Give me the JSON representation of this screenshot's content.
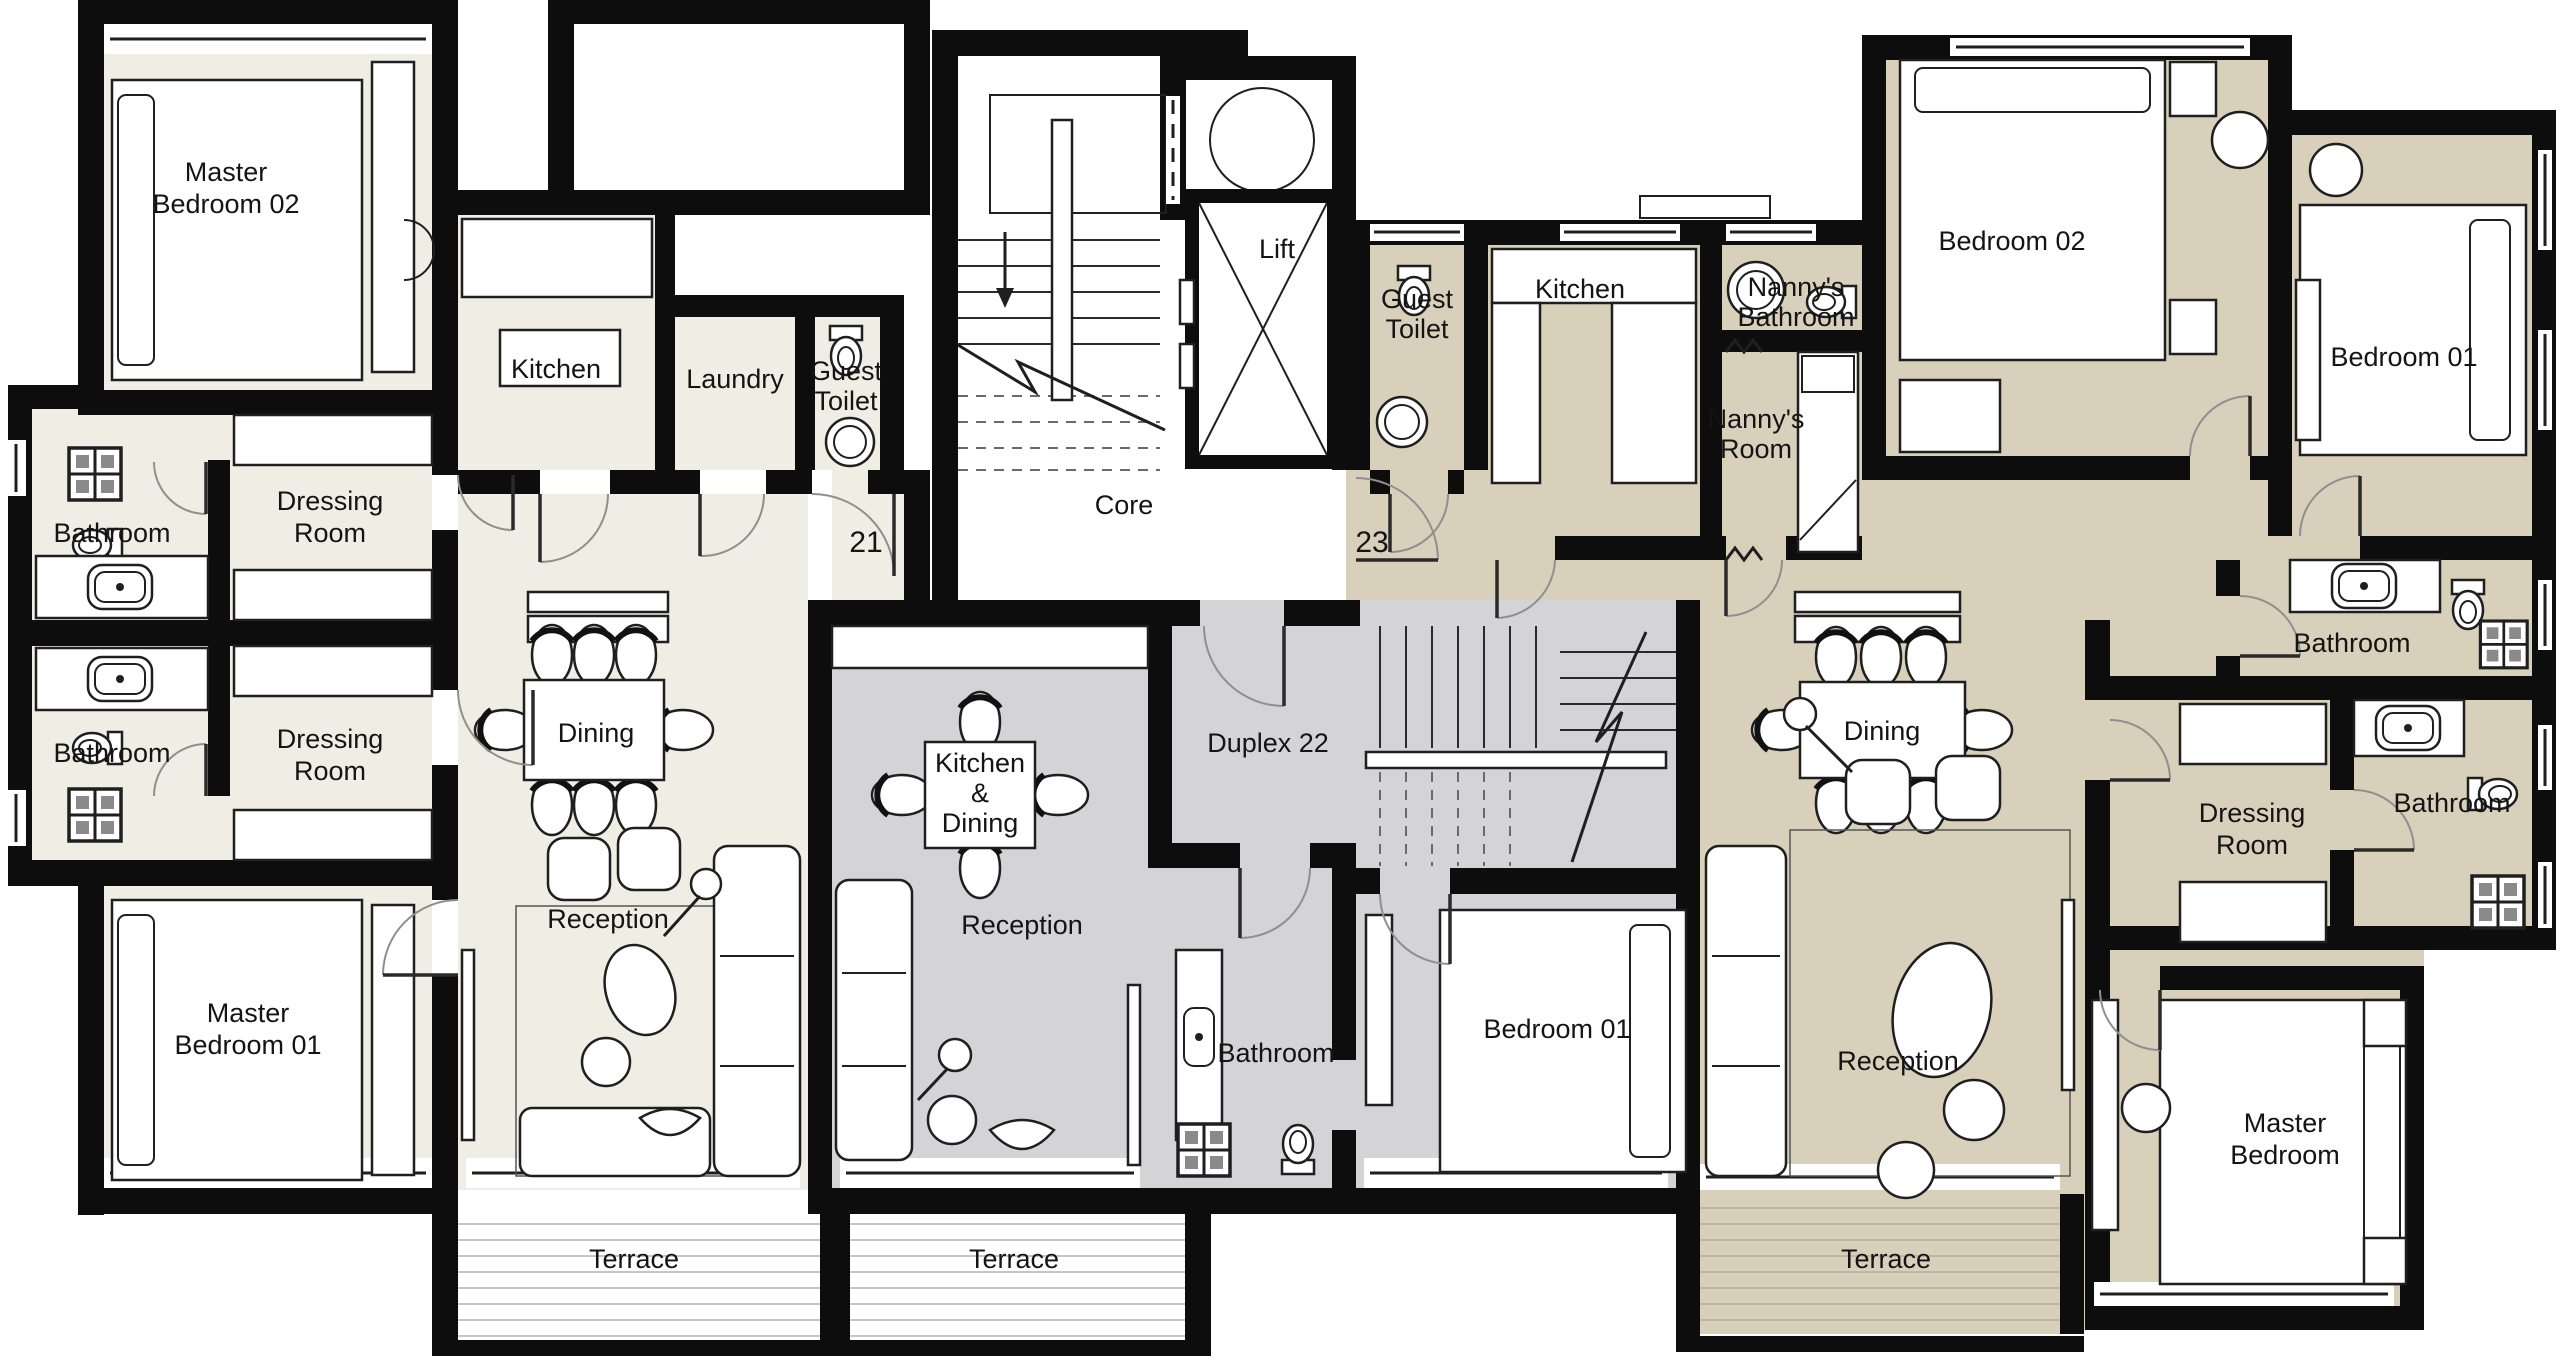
{
  "title": "Residential floor plan – units 21, 22 (duplex), 23",
  "core": {
    "label": "Core",
    "lift": "Lift"
  },
  "u21": {
    "number": "21",
    "master_bedroom_02": [
      "Master",
      "Bedroom 02"
    ],
    "bathroom_upper": "Bathroom",
    "dressing_room_upper": [
      "Dressing",
      "Room"
    ],
    "bathroom_lower": "Bathroom",
    "dressing_room_lower": [
      "Dressing",
      "Room"
    ],
    "master_bedroom_01": [
      "Master",
      "Bedroom 01"
    ],
    "kitchen": "Kitchen",
    "laundry": "Laundry",
    "guest_toilet": [
      "Guest",
      "Toilet"
    ],
    "dining": "Dining",
    "reception": "Reception",
    "terrace": "Terrace"
  },
  "u22": {
    "name": "Duplex 22",
    "kitchen_dining": [
      "Kitchen",
      "&",
      "Dining"
    ],
    "reception": "Reception",
    "bathroom": "Bathroom",
    "bedroom_01": "Bedroom 01",
    "terrace": "Terrace"
  },
  "u23": {
    "number": "23",
    "guest_toilet": [
      "Guest",
      "Toilet"
    ],
    "kitchen": "Kitchen",
    "nannys_bathroom": [
      "Nanny's",
      "Bathroom"
    ],
    "nannys_room": [
      "Nanny's",
      "Room"
    ],
    "bedroom_02": "Bedroom 02",
    "bedroom_01": "Bedroom 01",
    "bathroom_ensuite": "Bathroom",
    "dining": "Dining",
    "reception": "Reception",
    "dressing_room": [
      "Dressing",
      "Room"
    ],
    "bathroom": "Bathroom",
    "master_bedroom": [
      "Master",
      "Bedroom"
    ],
    "terrace": "Terrace"
  },
  "colors": {
    "unit21_fill": "#f0ede4",
    "unit22_fill": "#d4d4d7",
    "unit23_fill": "#d9d0bc",
    "wall": "#0d0d0d",
    "background": "#ffffff"
  }
}
